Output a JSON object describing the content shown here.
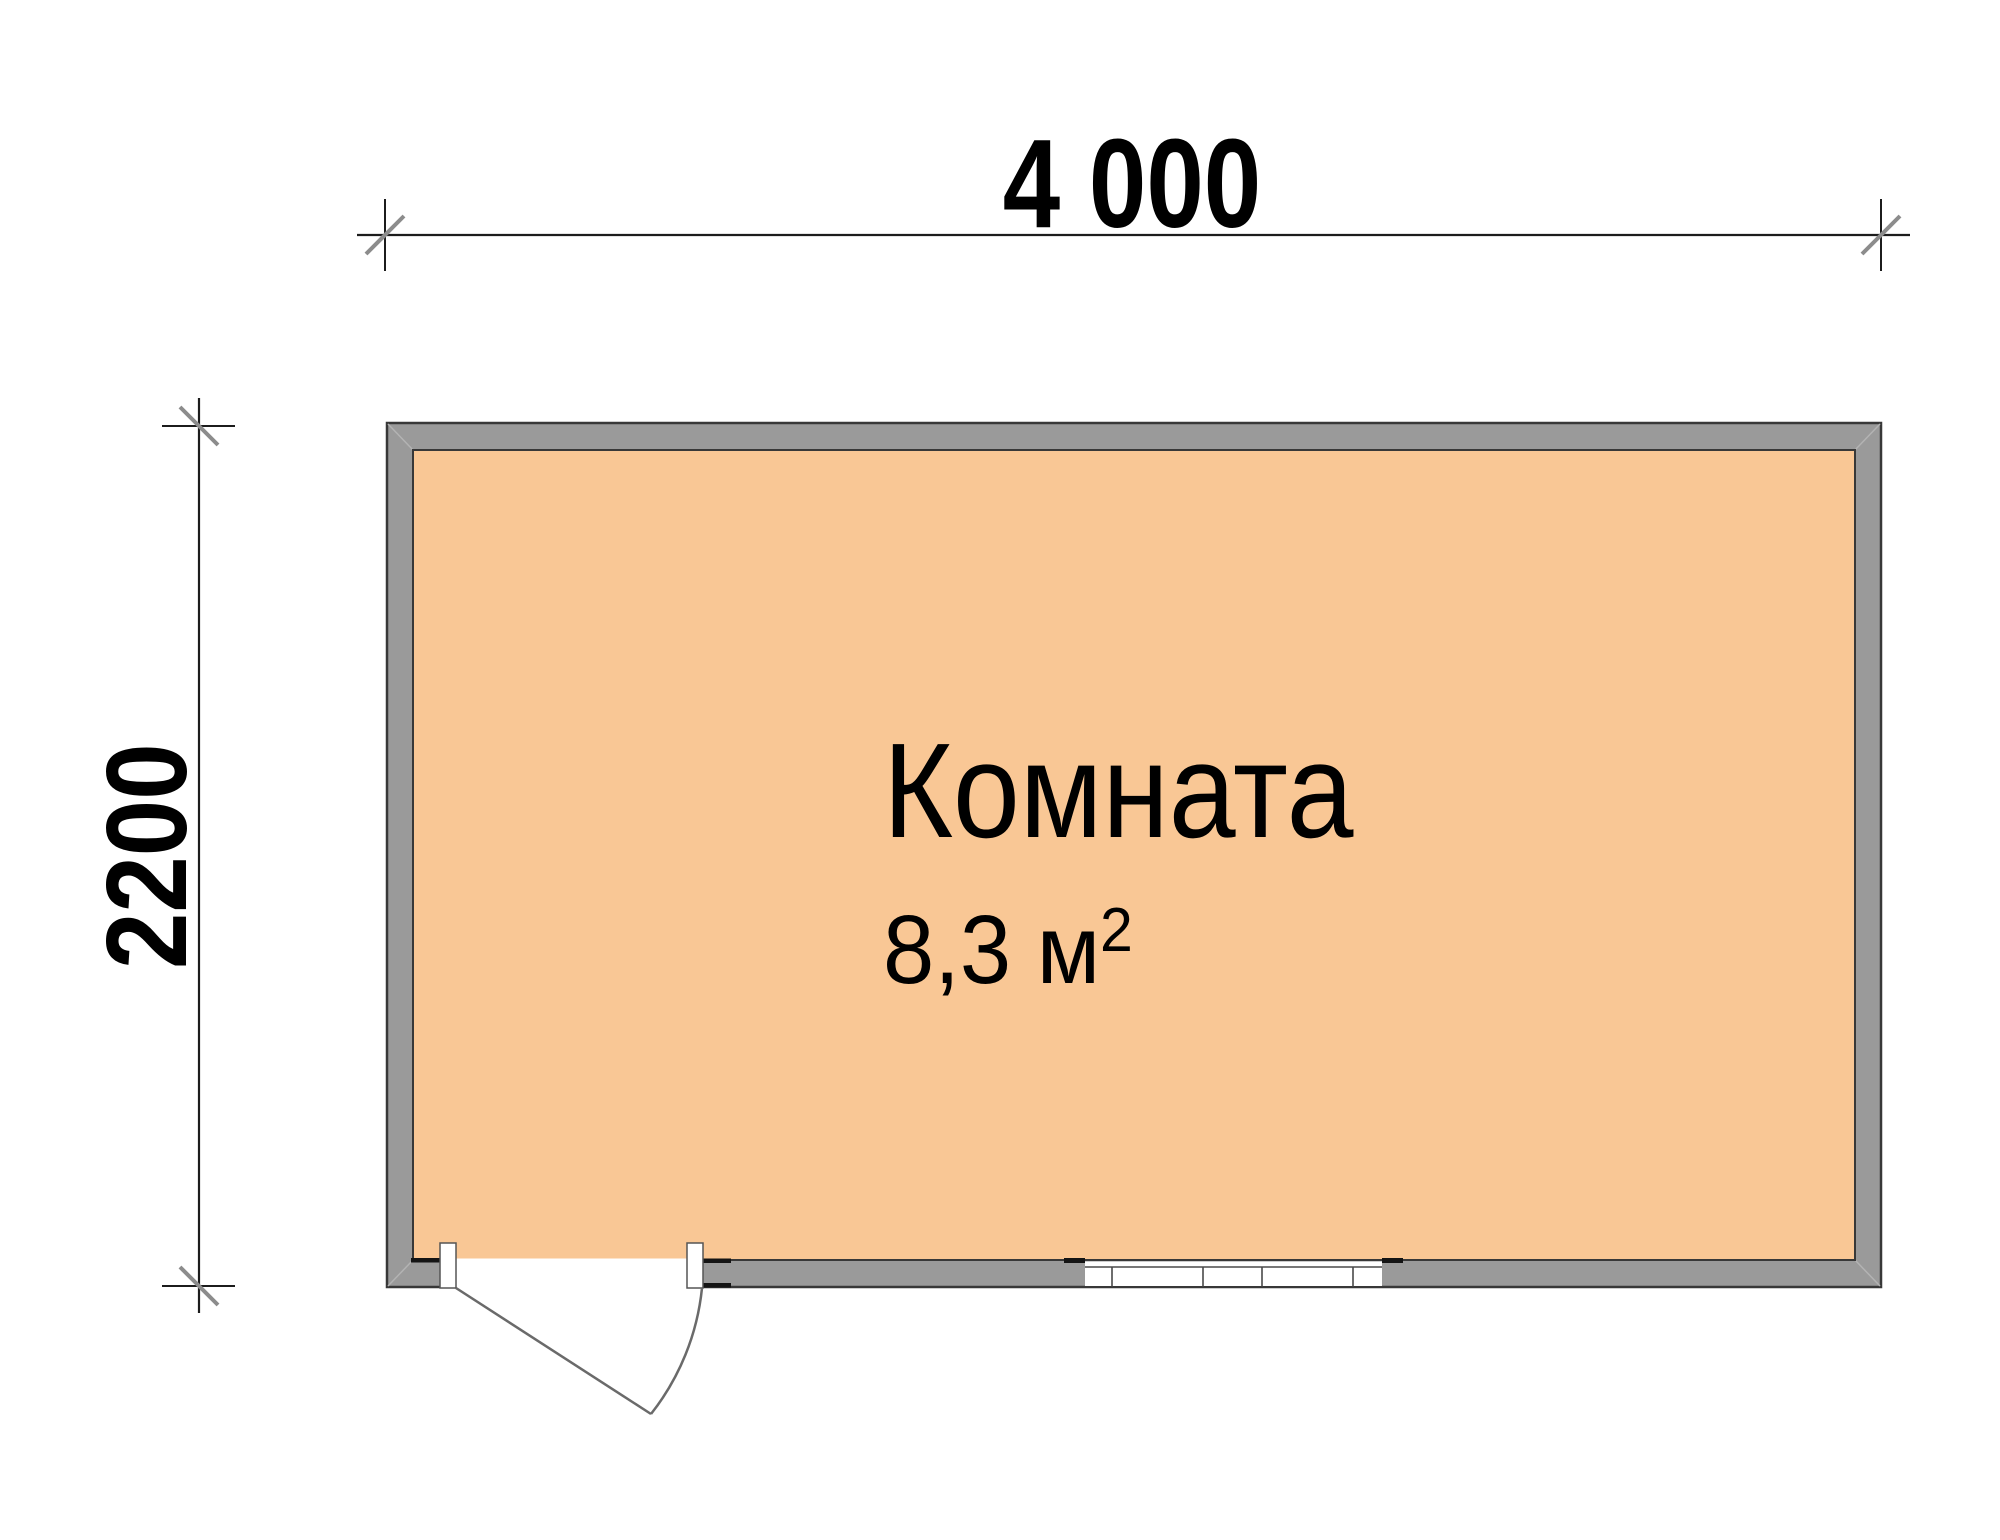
{
  "drawing": {
    "type": "floor-plan"
  },
  "dimensions": {
    "width": {
      "label": "4 000"
    },
    "height": {
      "label": "2200"
    }
  },
  "room": {
    "name": "Комната",
    "area_value": "8,3 м",
    "area_superscript": "2"
  },
  "colors": {
    "background": "#FFFFFF",
    "floor": "#F9C795",
    "wall": "#9A9A9A",
    "outline": "#383838",
    "dim_line": "#1C1C1C",
    "tick": "#8C8C8C",
    "door_line": "#6A6A6A",
    "window_line": "#4A4A4A",
    "text": "#000000"
  }
}
